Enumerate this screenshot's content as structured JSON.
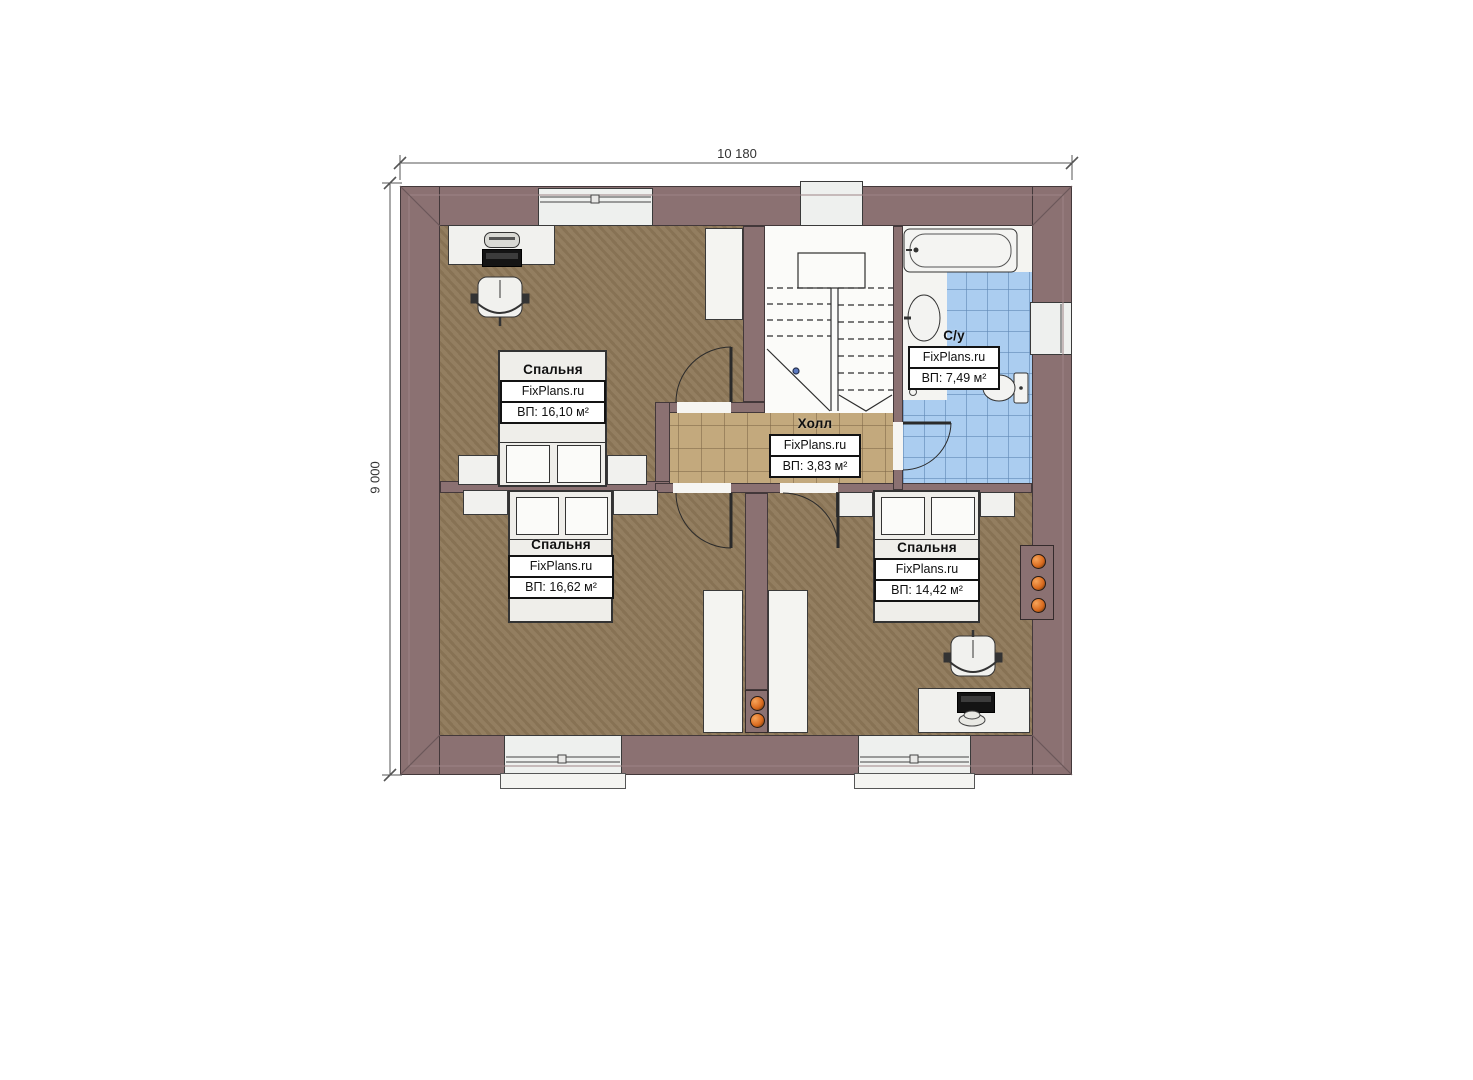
{
  "plan": {
    "dimensions": {
      "width_label": "10 180",
      "height_label": "9 000"
    },
    "rooms": [
      {
        "key": "bedroom-top-left",
        "title": "Спальня",
        "brand": "FixPlans.ru",
        "area": "ВП: 16,10 м²"
      },
      {
        "key": "bedroom-bottom-left",
        "title": "Спальня",
        "brand": "FixPlans.ru",
        "area": "ВП: 16,62 м²"
      },
      {
        "key": "bedroom-bottom-right",
        "title": "Спальня",
        "brand": "FixPlans.ru",
        "area": "ВП: 14,42 м²"
      },
      {
        "key": "hall",
        "title": "Холл",
        "brand": "FixPlans.ru",
        "area": "ВП: 3,83 м²"
      },
      {
        "key": "bathroom",
        "title": "С/у",
        "brand": "FixPlans.ru",
        "area": "ВП: 7,49 м²"
      }
    ],
    "colors": {
      "wall": "#8b7172",
      "wall_outline": "#43383a",
      "bedroom_floor": "#8d7758",
      "hall_tile": "#c3a97d",
      "bath_tile": "#abcdf0",
      "fixture_white": "#f1f1ee",
      "vent_orange": "#d96a1e"
    }
  }
}
